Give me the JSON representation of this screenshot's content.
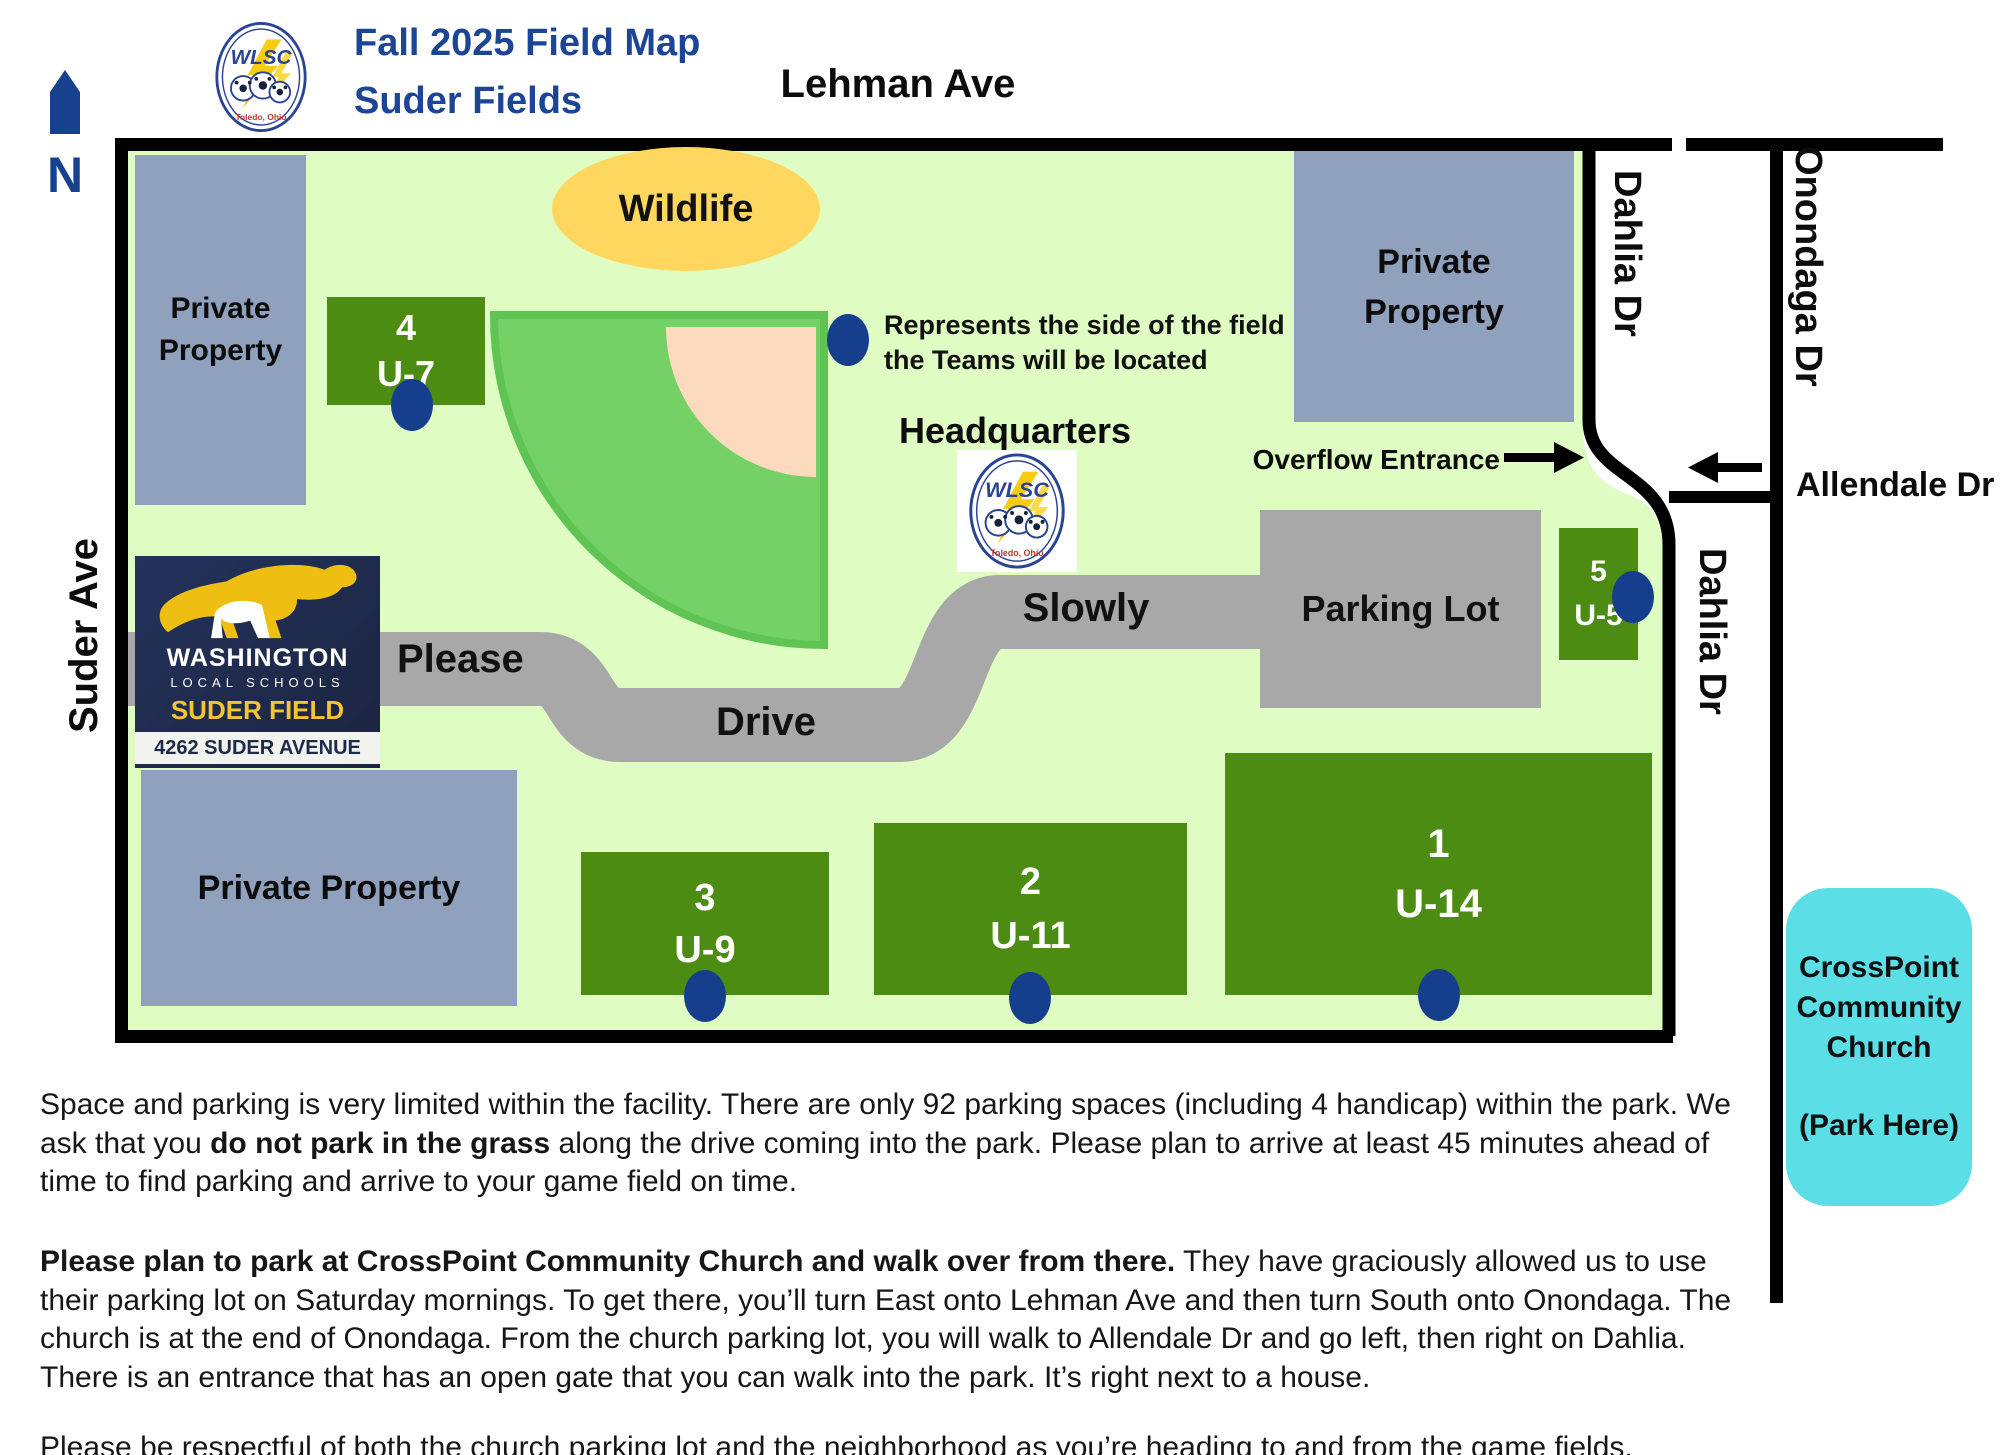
{
  "header": {
    "north_label": "N",
    "title_line1": "Fall 2025 Field Map",
    "title_line2": "Suder Fields",
    "logo": {
      "acronym": "WLSC",
      "city": "Toledo, Ohio"
    }
  },
  "streets": {
    "top": "Lehman Ave",
    "left": "Suder Ave",
    "dahlia": "Dahlia Dr",
    "onondaga": "Onondaga Dr",
    "allendale": "Allendale Dr"
  },
  "map": {
    "wildlife_label": "Wildlife",
    "legend": {
      "line1": "Represents the side of the field",
      "line2": "the Teams will be located"
    },
    "headquarters_label": "Headquarters",
    "overflow_label": "Overflow Entrance",
    "road": {
      "word1": "Please",
      "word2": "Drive",
      "word3": "Slowly"
    },
    "parking_label": "Parking Lot",
    "private_top_left": {
      "line1": "Private",
      "line2": "Property"
    },
    "private_top_right": {
      "line1": "Private",
      "line2": "Property"
    },
    "private_bottom": "Private Property",
    "fields": [
      {
        "number": "4",
        "age": "U-7"
      },
      {
        "number": "5",
        "age": "U-5"
      },
      {
        "number": "3",
        "age": "U-9"
      },
      {
        "number": "2",
        "age": "U-11"
      },
      {
        "number": "1",
        "age": "U-14"
      }
    ]
  },
  "sign": {
    "district": "WASHINGTON",
    "sub": "LOCAL SCHOOLS",
    "field": "SUDER FIELD",
    "address": "4262 SUDER AVENUE"
  },
  "church": {
    "line1": "CrossPoint",
    "line2": "Community",
    "line3": "Church",
    "line4": "(Park Here)"
  },
  "notes": {
    "p1_a": "Space and parking is very limited within the facility. There are only 92 parking spaces (including 4 handicap) within the park. We ask that you ",
    "p1_b": "do not park in the grass",
    "p1_c": " along the drive coming into the park. Please plan to arrive at least 45 minutes ahead of time to find parking and arrive to your game field on time.",
    "p2_a": "Please plan to park at CrossPoint Community Church and walk over from there.",
    "p2_b": " They have graciously allowed us to use their parking lot on Saturday mornings. To get there, you’ll turn East onto Lehman Ave and then turn South onto Onondaga. The church is at the end of Onondaga. From the church parking lot, you will walk to Allendale Dr and go left, then right on Dahlia. There is an entrance that has an open gate that you can walk into the park. It’s right next to a house.",
    "p3": "Please be respectful of both the church parking lot and the neighborhood as you’re heading to and from the game fields."
  },
  "colors": {
    "park_green": "#DFFCC3",
    "field_green": "#4C8C13",
    "outfield_green": "#74D166",
    "infield_peach": "#FCDABE",
    "road_gray": "#A8A8A8",
    "private_property": "#90A1BD",
    "dot_navy": "#153F8C",
    "wildlife_yellow": "#FFD75E",
    "church_cyan": "#5CDEE6",
    "title_blue": "#1C4596",
    "sign_navy": "#1D2A4A",
    "sign_gold": "#F4C431"
  }
}
